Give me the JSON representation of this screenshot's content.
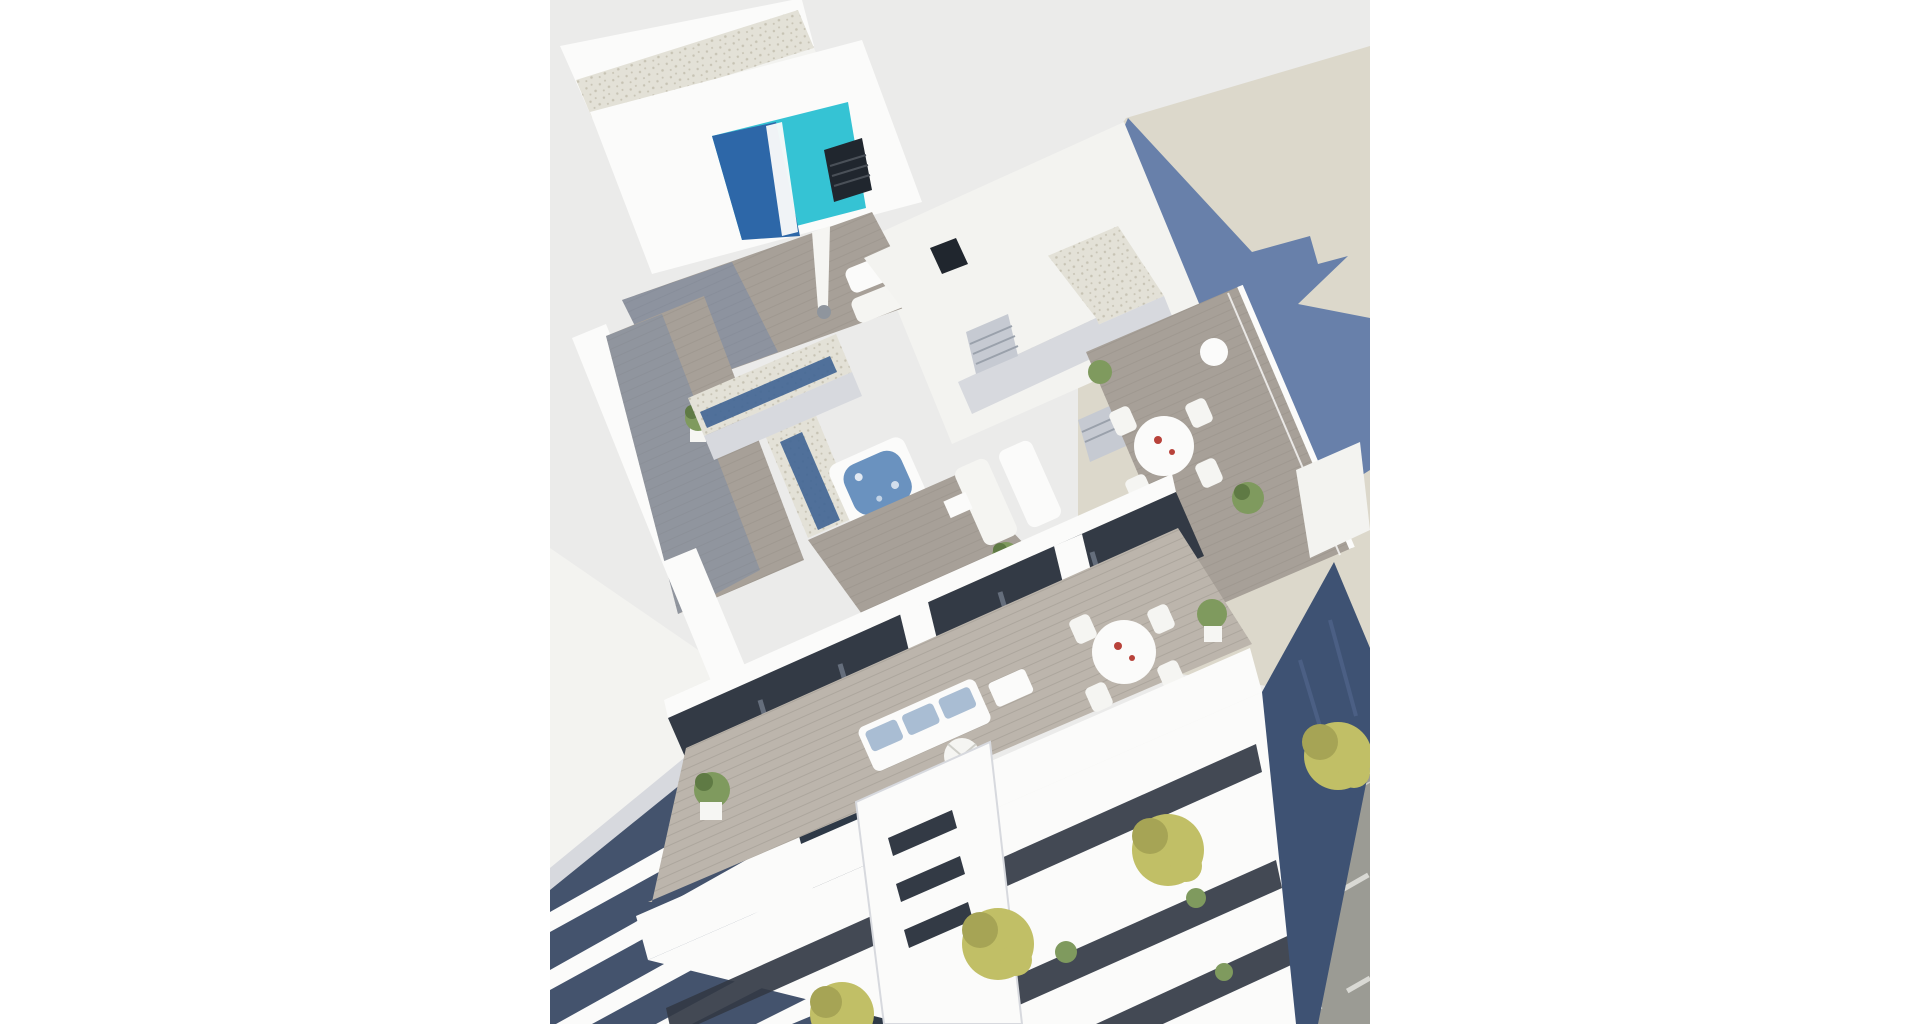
{
  "scene": {
    "kind": "architectural-3d-render",
    "subject": "aerial-view-apartment-building-with-rooftop-pool-terraces-and-street"
  },
  "colors": {
    "page_bg": "#ffffff",
    "backdrop": "#ebebea",
    "beige_plane": "#dcd8cb",
    "shadow_blue": "#6880aa",
    "shadow_soft": "#8c9ab8",
    "pool_bright": "#35c3d4",
    "pool_dark": "#2d67a8",
    "glass_strip": "#3f6493",
    "gravel": "#e3e1d7",
    "gravel_dot": "#c7c3b4",
    "deck": "#a7a098",
    "deck_light": "#bcb5ac",
    "plank_line": "#8f8880",
    "white_wall": "#fbfbfa",
    "wall_light": "#f3f3f0",
    "wall_shade": "#d7d9de",
    "wall_shade2": "#c6cad2",
    "dark_window": "#333a45",
    "glass_band": "#44536d",
    "canyon": "#2e3947",
    "hot_tub_water": "#6a92bf",
    "tub_wood": "#b4a896",
    "tree_green": "#c1bf66",
    "tree_dark": "#a6a455",
    "plant_green": "#7f9a5e",
    "plant_dark": "#5f7a44",
    "street": "#9b9b94",
    "sidewalk": "#abaaa2",
    "curb": "#e6e6e2",
    "lane_dash": "#d9d9d4",
    "navy_wall": "#3e5273",
    "red_accent": "#b8423a",
    "umbrella": "#f5f5f2",
    "metal": "#8f959d",
    "sofa_cushion": "#a9bdd3",
    "vent_black": "#20262e",
    "vent_line": "#4a5058",
    "white_pot": "#f6f6f3"
  }
}
